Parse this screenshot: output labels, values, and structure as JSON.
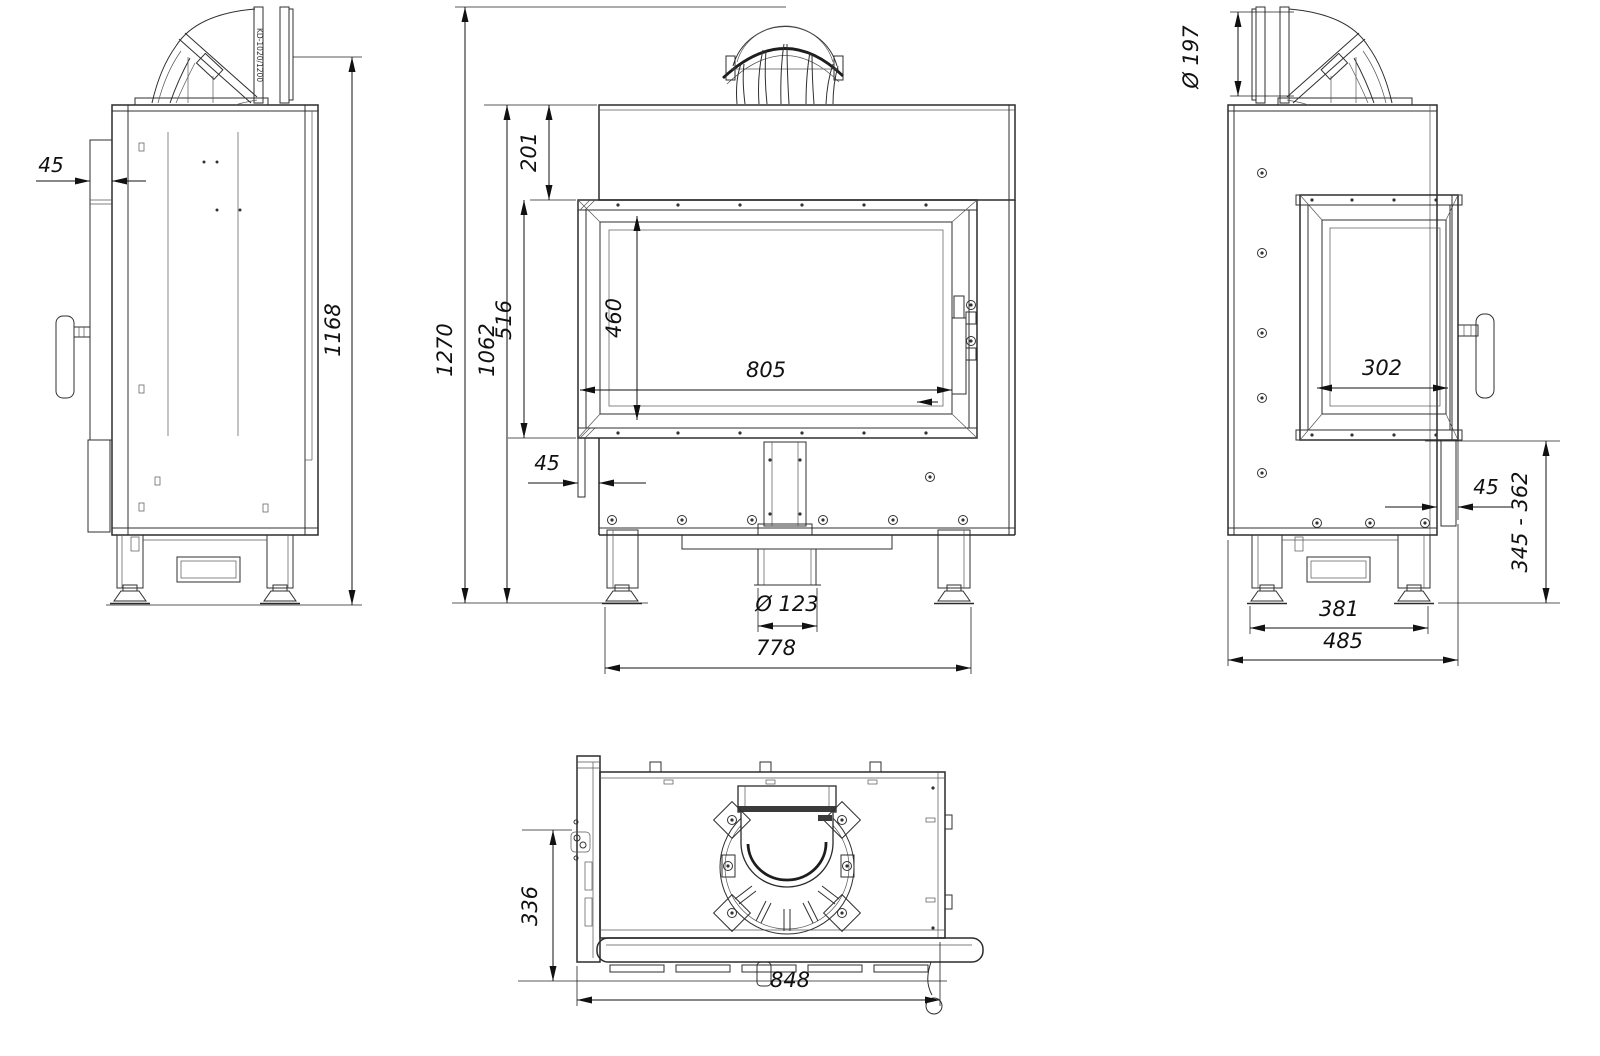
{
  "drawing": {
    "type": "fireplace-insert-technical-drawing",
    "line_color": "#2b2b2b",
    "background": "#ffffff",
    "views": {
      "left_side": {
        "flue_pipe_label": "KD-1020/1200",
        "dims": {
          "front_frame_offset": "45",
          "height_to_flue_axis": "1168"
        }
      },
      "front": {
        "dims": {
          "total_height": "1270",
          "body_height": "1062",
          "top_to_door": "201",
          "door_height": "516",
          "glass_height": "460",
          "glass_width": "805",
          "side_frame_offset": "45",
          "air_inlet_diameter": "Ø 123",
          "feet_span": "778"
        }
      },
      "right_side": {
        "dims": {
          "flue_diameter": "Ø 197",
          "side_glass_width": "302",
          "front_frame_offset": "45",
          "plinth_height_range": "345 - 362",
          "feet_span": "381",
          "overall_depth": "485"
        }
      },
      "top": {
        "dims": {
          "body_depth": "336",
          "overall_width": "848"
        }
      }
    }
  }
}
